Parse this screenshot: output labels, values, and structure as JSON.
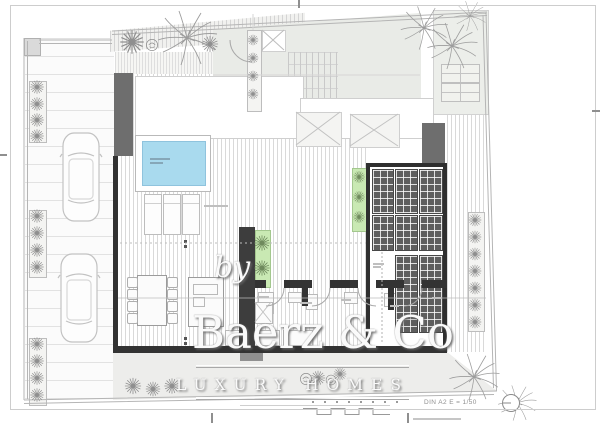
{
  "watermark": {
    "prefix": "by",
    "brand": "Baerz & Co",
    "tagline": "LUXURY HOMES"
  },
  "titleblock": {
    "scale_label": "DIN A2 E = 1/50"
  },
  "icons": {
    "palm": "palm-tree-icon",
    "shrub": "star-shrub-icon",
    "bush": "round-bush-icon",
    "car": "car-top-view-icon",
    "north": "north-marker-icon"
  },
  "colors": {
    "wall_dark": "#333333",
    "wall_mid": "#6e6e6e",
    "pergola_panel": "#5e5e5e",
    "pool_water": "#a9daee",
    "planter_green": "#c9e9b3",
    "building_fill": "#e9ebe7",
    "garden_fill": "#ededeb"
  }
}
